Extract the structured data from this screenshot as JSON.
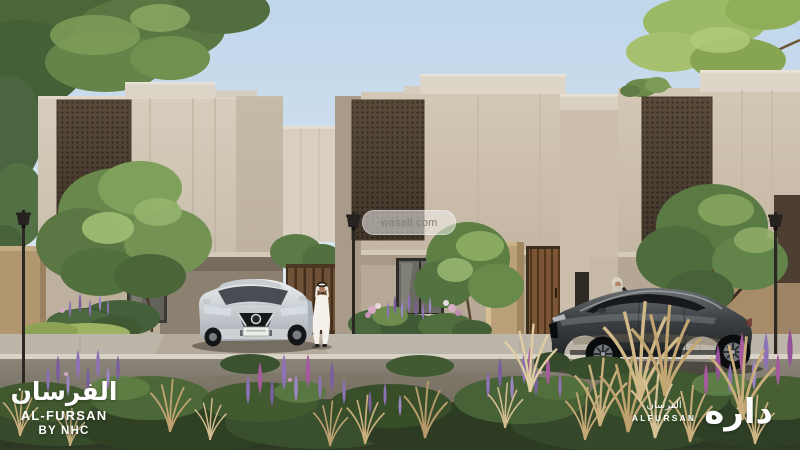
{
  "watermark": {
    "text": "wasalt.com"
  },
  "branding_left": {
    "arabic_title": "الفرسان",
    "latin_title": "AL-FURSAN",
    "subtitle": "BY NHC"
  },
  "branding_right": {
    "arabic_small": "الفرسان",
    "latin_small": "ALFURSAN",
    "arabic_wordmark": "داره"
  },
  "palette": {
    "sky_top": "#bfd6eb",
    "sky_horizon": "#edf0f0",
    "wall_light": "#d6cbba",
    "wall_shadow": "#a89b89",
    "parapet_light": "#ddd5c8",
    "mashrabiya_brown": "#594a3a",
    "mashrabiya_hole": "#2e251c",
    "wood_door": "#7a5636",
    "fence_tan": "#b1976f",
    "warm_doorway": "#c07c42",
    "sidewalk": "#bcb5a9",
    "curb": "#d9d3c7",
    "road": "#7c7569",
    "foliage_dark": "#42592f",
    "foliage_light": "#9cb965",
    "flower_purple": "#8d72b4",
    "flower_magenta": "#a55a9e",
    "grass_wheat": "#c9ae7e",
    "suv_silver": "#d9dde1",
    "sedan_gunmetal": "#3c4043",
    "text_white": "#ffffff"
  }
}
